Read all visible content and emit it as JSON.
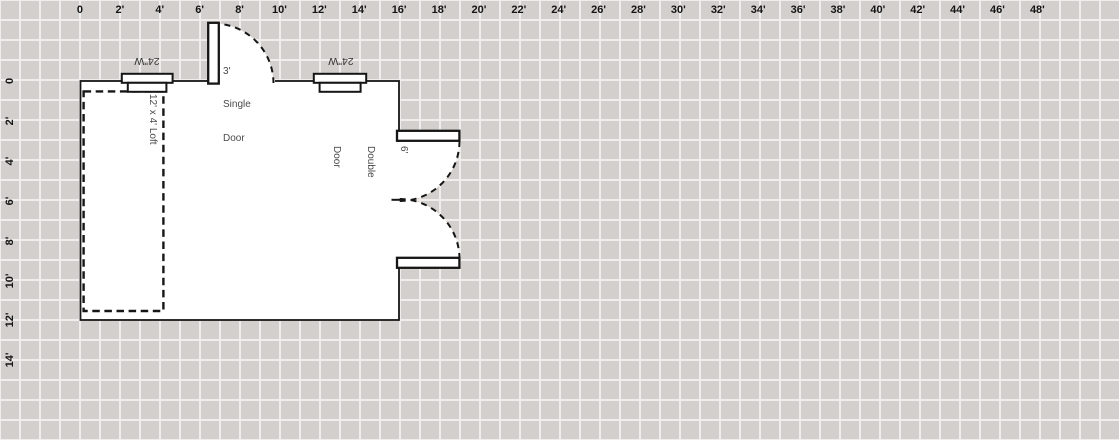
{
  "canvas": {
    "background_color": "#d2cfcc",
    "grid_line_color": "#f0eeec",
    "grid_cell_px": 20,
    "grid_cell_feet": 1
  },
  "rulers": {
    "top": [
      "0",
      "2'",
      "4'",
      "6'",
      "8'",
      "10'",
      "12'",
      "14'",
      "16'",
      "18'",
      "20'",
      "22'",
      "24'",
      "26'",
      "28'",
      "30'",
      "32'",
      "34'",
      "36'",
      "38'",
      "40'",
      "42'",
      "44'",
      "46'",
      "48'"
    ],
    "left": [
      "0",
      "2'",
      "4'",
      "6'",
      "8'",
      "10'",
      "12'",
      "14'"
    ]
  },
  "plan": {
    "colors": {
      "wall": "#161616",
      "floor": "#ffffff"
    },
    "loft": {
      "label": "12' x 4' Loft"
    },
    "windows": [
      {
        "label": "24\"W"
      },
      {
        "label": "24\"W"
      }
    ],
    "single_door": {
      "lines": [
        "3'",
        "Single",
        "Door"
      ]
    },
    "double_door": {
      "lines": [
        "6'",
        "Double",
        "Door"
      ]
    }
  }
}
